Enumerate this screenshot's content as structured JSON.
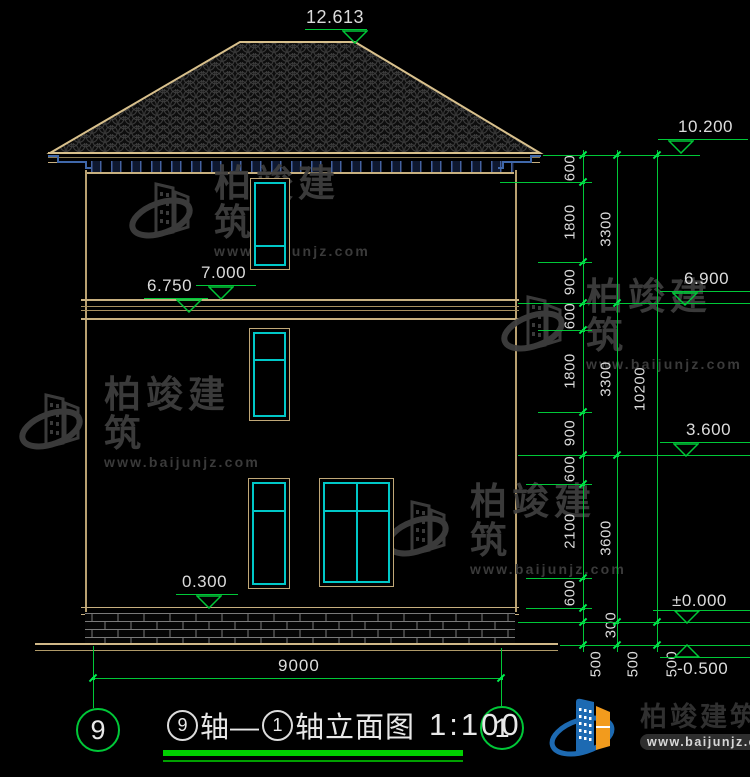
{
  "drawing_title": {
    "axis_start": "9",
    "axis_end": "1",
    "title_segments": {
      "circle_a": "9",
      "mid": "轴—",
      "circle_b": "1",
      "tail": "轴立面图"
    },
    "scale": "1:100"
  },
  "level_markers": {
    "ridge": "12.613",
    "eave": "10.200",
    "floor3": "6.900",
    "floor2": "3.600",
    "zero": "±0.000",
    "ground": "-0.500",
    "band_top": "7.000",
    "band_bottom": "6.750",
    "plinth": "0.300"
  },
  "dimensions": {
    "chain_inner": [
      "600",
      "1800",
      "900",
      "600",
      "1800",
      "900",
      "600",
      "2100",
      "600",
      "300",
      "500"
    ],
    "chain_middle": [
      "3300",
      "3300",
      "3600",
      "500"
    ],
    "chain_outer": [
      "10200",
      "500"
    ],
    "width_total": "9000"
  },
  "watermark": {
    "name": "柏竣建筑",
    "url": "www.baijunjz.com"
  },
  "brand": {
    "name": "柏竣建筑",
    "url": "www.baijunjz.com",
    "blue": "#1d6ab2",
    "orange": "#f29b1d"
  },
  "colors": {
    "line_tan": "#c8b080",
    "dim_green": "#00c838",
    "glass_cyan": "#00c8c8",
    "rafter_blue": "#44619e",
    "watermark_gray": "#3e3e3e",
    "text_white": "#dcdcdc"
  }
}
